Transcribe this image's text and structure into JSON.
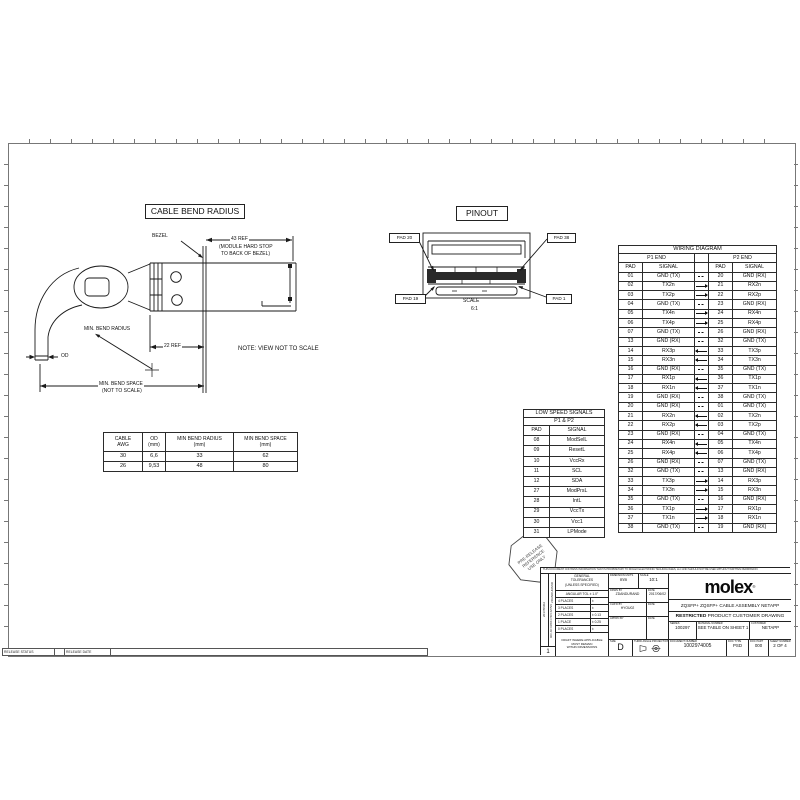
{
  "cable_bend": {
    "title": "CABLE BEND RADIUS",
    "bezel_label": "BEZEL",
    "dim_43": "43 REF",
    "dim_43_note1": "(MODULE HARD STOP",
    "dim_43_note2": "TO BACK OF BEZEL)",
    "dim_22": "22 REF",
    "min_bend_radius_label": "MIN. BEND RADIUS",
    "od_label": "OD",
    "min_bend_space_label": "MIN. BEND SPACE",
    "min_bend_space_note": "(NOT TO SCALE)",
    "view_note": "NOTE: VIEW NOT TO SCALE"
  },
  "cable_table": {
    "headers": [
      {
        "l1": "CABLE",
        "l2": "AWG"
      },
      {
        "l1": "OD",
        "l2": "(mm)"
      },
      {
        "l1": "MIN BEND RADIUS",
        "l2": "(mm)"
      },
      {
        "l1": "MIN BEND SPACE",
        "l2": "(mm)"
      }
    ],
    "rows": [
      [
        "30",
        "6,6",
        "33",
        "62"
      ],
      [
        "26",
        "9,53",
        "48",
        "80"
      ]
    ]
  },
  "pinout": {
    "title": "PINOUT",
    "pad_top_left": "PAD 20",
    "pad_top_right": "PAD 38",
    "pad_bottom_left": "PAD 19",
    "pad_bottom_right": "PAD 1",
    "scale_label": "SCALE",
    "scale_value": "6:1"
  },
  "low_speed": {
    "title": "LOW SPEED SIGNALS",
    "subtitle": "P1 & P2",
    "headers": [
      "PAD",
      "SIGNAL"
    ],
    "rows": [
      [
        "08",
        "ModSelL"
      ],
      [
        "09",
        "ResetL"
      ],
      [
        "10",
        "VccRx"
      ],
      [
        "11",
        "SCL"
      ],
      [
        "12",
        "SDA"
      ],
      [
        "27",
        "ModPrsL"
      ],
      [
        "28",
        "IntL"
      ],
      [
        "29",
        "VccTx"
      ],
      [
        "30",
        "Vcc1"
      ],
      [
        "31",
        "LPMode"
      ]
    ]
  },
  "wiring": {
    "title": "WIRING DIAGRAM",
    "p1_header": "P1 END",
    "p2_header": "P2 END",
    "col_headers": [
      "PAD",
      "SIGNAL",
      "",
      "PAD",
      "SIGNAL"
    ],
    "rows": [
      [
        "01",
        "GND (TX)",
        "none",
        "20",
        "GND (RX)"
      ],
      [
        "02",
        "TX2n",
        "right",
        "21",
        "RX2n"
      ],
      [
        "03",
        "TX2p",
        "right",
        "22",
        "RX2p"
      ],
      [
        "04",
        "GND (TX)",
        "none",
        "23",
        "GND (RX)"
      ],
      [
        "05",
        "TX4n",
        "right",
        "24",
        "RX4n"
      ],
      [
        "06",
        "TX4p",
        "right",
        "25",
        "RX4p"
      ],
      [
        "07",
        "GND (TX)",
        "none",
        "26",
        "GND (RX)"
      ],
      [
        "13",
        "GND (RX)",
        "none",
        "32",
        "GND (TX)"
      ],
      [
        "14",
        "RX3p",
        "left",
        "33",
        "TX3p"
      ],
      [
        "15",
        "RX3n",
        "left",
        "34",
        "TX3n"
      ],
      [
        "16",
        "GND (RX)",
        "none",
        "35",
        "GND (TX)"
      ],
      [
        "17",
        "RX1p",
        "left",
        "36",
        "TX1p"
      ],
      [
        "18",
        "RX1n",
        "left",
        "37",
        "TX1n"
      ],
      [
        "19",
        "GND (RX)",
        "none",
        "38",
        "GND (TX)"
      ],
      [
        "20",
        "GND (RX)",
        "none",
        "01",
        "GND (TX)"
      ],
      [
        "21",
        "RX2n",
        "left",
        "02",
        "TX2n"
      ],
      [
        "22",
        "RX2p",
        "left",
        "03",
        "TX2p"
      ],
      [
        "23",
        "GND (RX)",
        "none",
        "04",
        "GND (TX)"
      ],
      [
        "24",
        "RX4n",
        "left",
        "05",
        "TX4n"
      ],
      [
        "25",
        "RX4p",
        "left",
        "06",
        "TX4p"
      ],
      [
        "26",
        "GND (RX)",
        "none",
        "07",
        "GND (TX)"
      ],
      [
        "32",
        "GND (TX)",
        "none",
        "13",
        "GND (RX)"
      ],
      [
        "33",
        "TX3p",
        "right",
        "14",
        "RX3p"
      ],
      [
        "34",
        "TX3n",
        "right",
        "15",
        "RX3n"
      ],
      [
        "35",
        "GND (TX)",
        "none",
        "16",
        "GND (RX)"
      ],
      [
        "36",
        "TX1p",
        "right",
        "17",
        "RX1p"
      ],
      [
        "37",
        "TX1n",
        "right",
        "18",
        "RX1n"
      ],
      [
        "38",
        "GND (TX)",
        "none",
        "19",
        "GND (RX)"
      ]
    ]
  },
  "stamp": {
    "line1": "PRE-RELEASE",
    "line2": "REFERENCE",
    "line3": "USE ONLY"
  },
  "title_block": {
    "disclaimer": "THIS DOCUMENT CONTAINS INFORMATION THAT IS PROPRIETARY TO MOLEX ELECTRONIC TECHNOLOGIES, LLC AND SHOULD NOT BE USED WITHOUT WRITTEN PERMISSION",
    "side_date": "2017/06/02",
    "side_name": "ZDANDURAND",
    "side_labels": "DOC-NO DRWN CHK'D APPVD",
    "sheet_index": "1",
    "general_tolerances_l1": "GENERAL",
    "general_tolerances_l2": "TOLERANCES",
    "general_tolerances_l3": "(UNLESS SPECIFIED)",
    "angular_tol": "ANGULAR TOL ± 1.0°",
    "places": [
      [
        "4 PLACES",
        "±"
      ],
      [
        "3 PLACES",
        "±"
      ],
      [
        "2 PLACES",
        "± 0.13"
      ],
      [
        "1 PLACE",
        "± 0.25"
      ],
      [
        "0 PLACES",
        "±"
      ]
    ],
    "draft_note_l1": "DRAFT WHERE APPLICABLE",
    "draft_note_l2": "MUST REMAIN",
    "draft_note_l3": "WITHIN DIMENSIONS",
    "units_label": "DIMENSION UNITS",
    "units_value": "mm",
    "scale_label": "SCALE",
    "scale_value": "10:1",
    "drawn_label": "DRWN BY",
    "drawn_value": "ZDANDURAND",
    "drawn_date_label": "DATE",
    "drawn_date": "2017/06/02",
    "checked_label": "CHK'D BY",
    "checked_value": "HYOU02",
    "checked_date_label": "DATE",
    "approved_label": "APPR'D BY",
    "approved_date_label": "DATE",
    "size_label": "SIZE",
    "size_value": "D",
    "projection_label": "THIRD ANGLE PROJECTION",
    "logo": "molex",
    "logo_mark": "®",
    "product_title": "ZQSFP+ ZQSFP+ CABLE ASSEMBLY NETAPP",
    "restricted_bold": "RESTRICTED",
    "restricted_rest": " PRODUCT CUSTOMER DRAWING",
    "series_label": "SERIES",
    "series_value": "100297",
    "material_label": "MATERIAL NUMBER",
    "material_value": "SEE TABLE ON SHEET 1",
    "customer_label": "CUSTOMER",
    "customer_value": "NETAPP",
    "doc_number_label": "DOCUMENT NUMBER",
    "doc_number_value": "1002974005",
    "doc_type_label": "DOC TYPE",
    "doc_type_value": "PSD",
    "doc_part_label": "DOC PART",
    "doc_part_value": "000",
    "sheet_label": "SHEET NUMBER",
    "sheet_value": "2 OF 4"
  },
  "release_bar": {
    "status_label": "RELEASE STATUS",
    "date_label": "RELEASE DATE"
  }
}
